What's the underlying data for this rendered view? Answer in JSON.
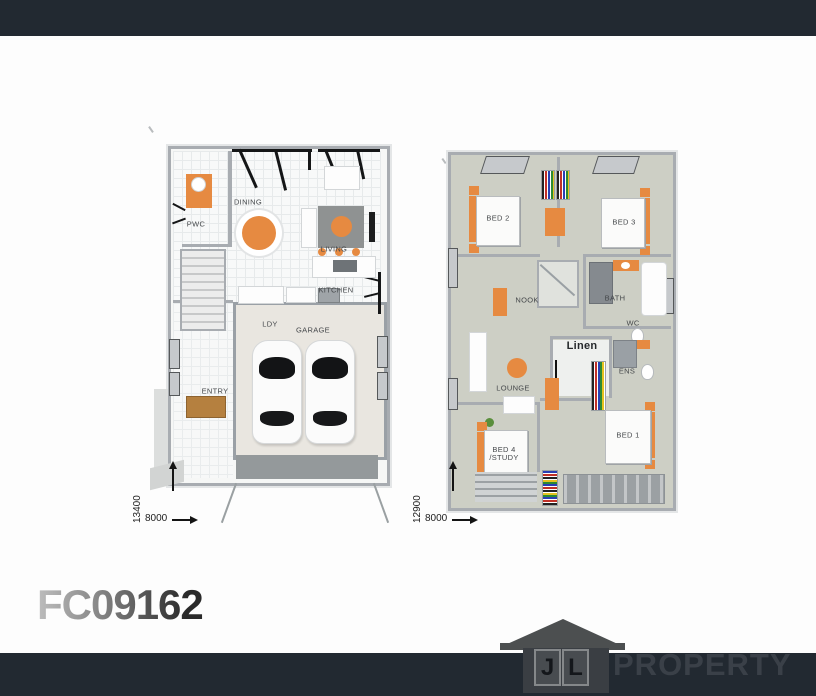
{
  "plan_code": "FC09162",
  "ground_floor": {
    "labels": {
      "dining": "DINING",
      "pwc": "PWC",
      "living": "LIVING",
      "kitchen": "KITCHEN",
      "ldy": "LDY",
      "garage": "GARAGE",
      "entry": "ENTRY"
    },
    "dimensions": {
      "depth": "13400",
      "width": "8000"
    }
  },
  "first_floor": {
    "labels": {
      "bed2": "BED 2",
      "bed3": "BED 3",
      "nook": "NOOK",
      "bath": "BATH",
      "wc": "WC",
      "linen": "Linen",
      "ens": "ENS",
      "lounge": "LOUNGE",
      "bed4_line1": "BED 4",
      "bed4_line2": "/STUDY",
      "bed1": "BED 1"
    },
    "dimensions": {
      "depth": "12900",
      "width": "8000"
    }
  },
  "branding": {
    "logo_letter_1": "J",
    "logo_letter_2": "L",
    "logo_text": "PROPERTY"
  },
  "colors": {
    "banner": "#222931",
    "accent_orange": "#E68A41",
    "upper_floor": "#CDCFC5",
    "wall_gray": "#A8ACB1",
    "code_dark": "#2A2A2A",
    "logo_gray": "#4C4F50"
  }
}
